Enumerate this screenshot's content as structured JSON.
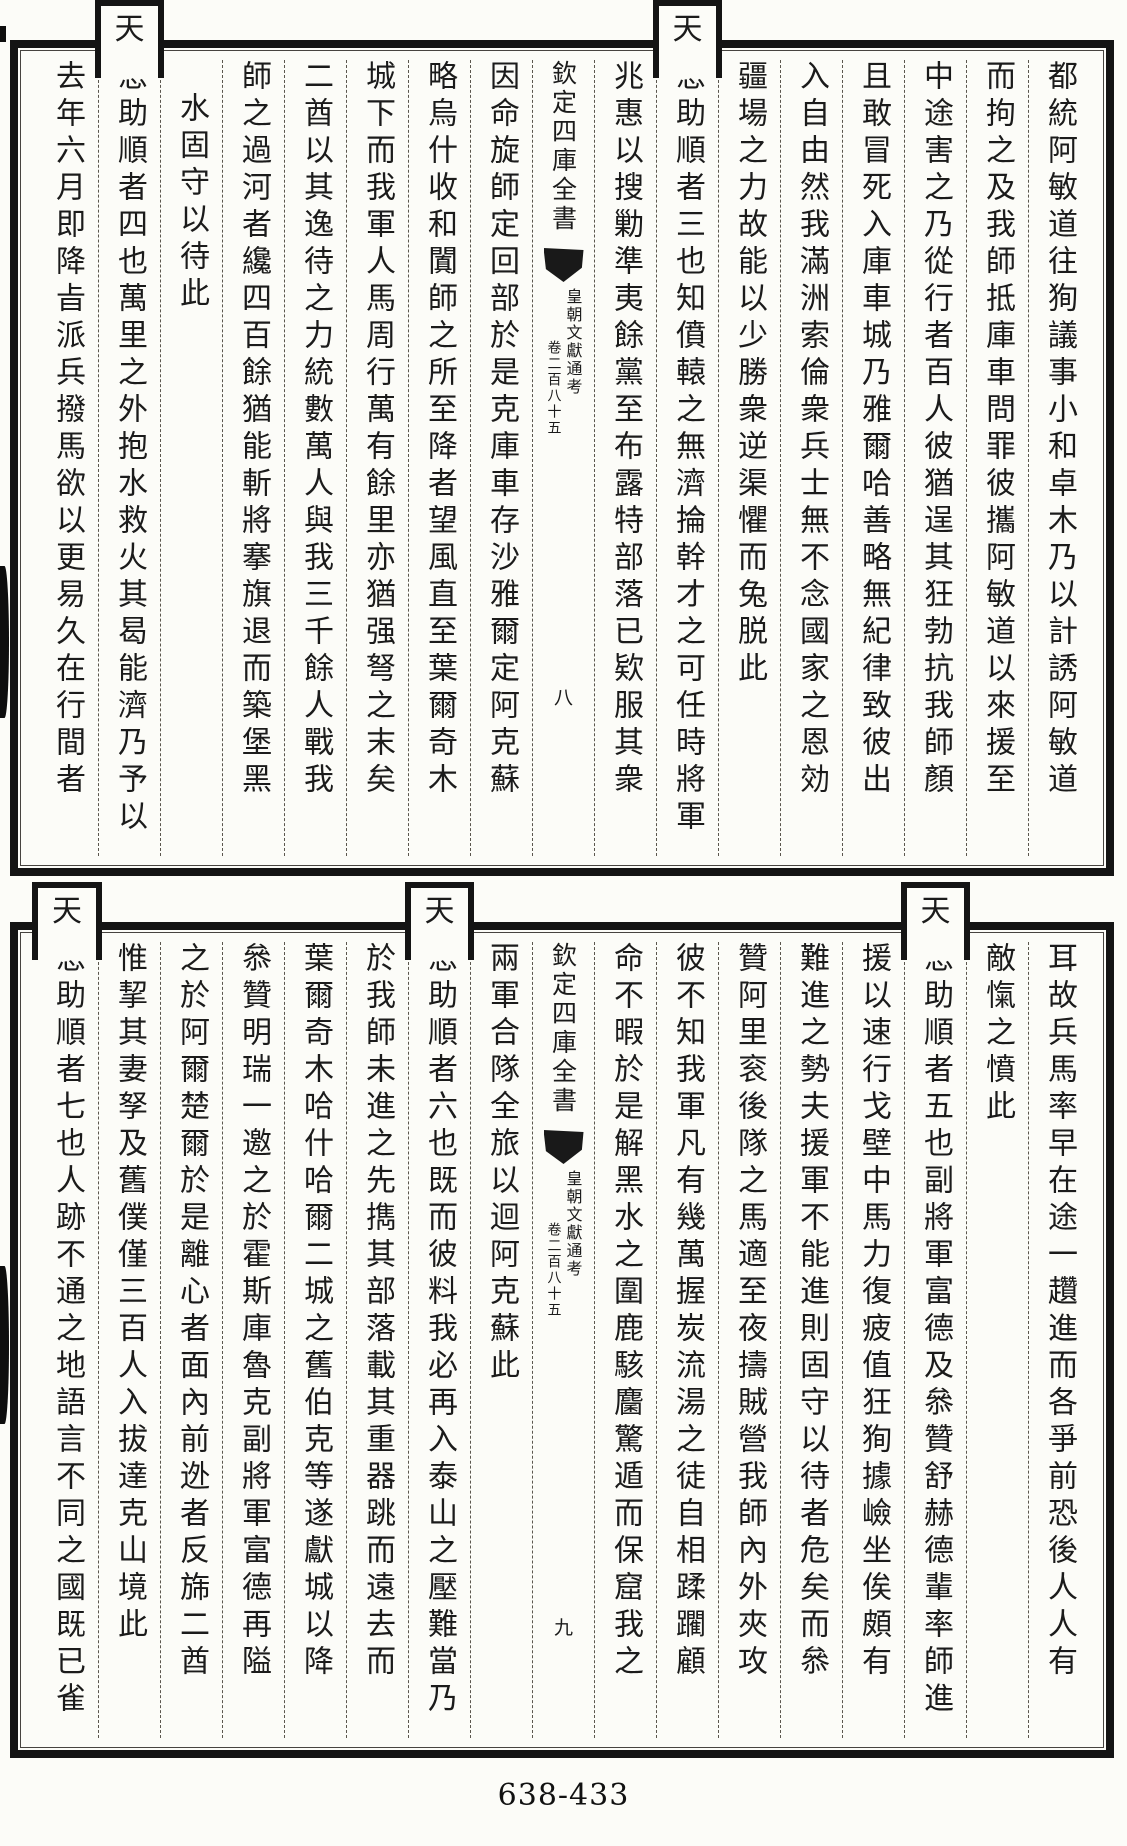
{
  "page": {
    "catalog_number": "638-433",
    "paper_color": "#fcfcf8",
    "ink_color": "#1b1b1b"
  },
  "upper_block": {
    "page_number": "八",
    "banxin": {
      "series_title": "欽定四庫全書",
      "book_title": "皇朝文獻通考",
      "chapter": "卷二百八十五"
    },
    "right_columns": [
      {
        "text": "都統阿敏道往狥議事小和卓木乃以計誘阿敏道"
      },
      {
        "text": "而拘之及我師抵庫車問罪彼攜阿敏道以來援至"
      },
      {
        "text": "中途害之乃從行者百人彼猶逞其狂勃抗我師顏"
      },
      {
        "text": "且敢冒死入庫車城乃雅爾哈善略無紀律致彼出"
      },
      {
        "text": "入自由然我滿洲索倫衆兵士無不念國家之恩効"
      },
      {
        "text": "疆場之力故能以少勝衆逆渠懼而兔脱此"
      },
      {
        "raised_char": "天",
        "text": "恩助順者三也知僨轅之無濟掄幹才之可任時將軍"
      },
      {
        "text": "兆惠以搜勦準夷餘黨至布露特部落已欵服其衆"
      }
    ],
    "left_columns": [
      {
        "text": "因命旋師定回部於是克庫車存沙雅爾定阿克蘇"
      },
      {
        "text": "略烏什收和闐師之所至降者望風直至葉爾奇木"
      },
      {
        "text": "城下而我軍人馬周行萬有餘里亦猶强弩之末矣"
      },
      {
        "text": "二酋以其逸待之力統數萬人與我三千餘人戰我"
      },
      {
        "text": "師之過河者纔四百餘猶能斬將搴旗退而築堡黑"
      },
      {
        "text": "水固守以待此"
      },
      {
        "raised_char": "天",
        "text": "恩助順者四也萬里之外抱水救火其曷能濟乃予以"
      },
      {
        "text": "去年六月即降㫖派兵撥馬欲以更易久在行間者"
      }
    ]
  },
  "lower_block": {
    "page_number": "九",
    "banxin": {
      "series_title": "欽定四庫全書",
      "book_title": "皇朝文獻通考",
      "chapter": "卷二百八十五"
    },
    "right_columns": [
      {
        "text": "耳故兵馬率早在途一趲進而各爭前恐後人人有"
      },
      {
        "text": "敵愾之憤此"
      },
      {
        "raised_char": "天",
        "text": "恩助順者五也副將軍富德及叅贊舒赫德輩率師進"
      },
      {
        "text": "援以速行戈壁中馬力復疲值狂狥據嶮坐俟頗有"
      },
      {
        "text": "難進之勢夫援軍不能進則固守以待者危矣而叅"
      },
      {
        "text": "贊阿里衮後隊之馬適至夜擣賊營我師內外夾攻"
      },
      {
        "text": "彼不知我軍凡有幾萬握炭流湯之徒自相蹂躙顧"
      },
      {
        "text": "命不暇於是解黑水之圍鹿駭麕驚遁而保窟我之"
      }
    ],
    "left_columns": [
      {
        "text": "兩軍合隊全旅以迴阿克蘇此"
      },
      {
        "raised_char": "天",
        "text": "恩助順者六也既而彼料我必再入泰山之壓難當乃"
      },
      {
        "text": "於我師未進之先擕其部落載其重器跳而遠去而"
      },
      {
        "text": "葉爾奇木哈什哈爾二城之舊伯克等遂獻城以降"
      },
      {
        "text": "叅贊明瑞一邀之於霍斯庫魯克副將軍富德再隘"
      },
      {
        "text": "之於阿爾楚爾於是離心者面內前迯者反旆二酋"
      },
      {
        "text": "惟挈其妻孥及舊僕僅三百人入拔達克山境此"
      },
      {
        "raised_char": "天",
        "text": "恩助順者七也人跡不通之地語言不同之國既已雀"
      }
    ]
  }
}
